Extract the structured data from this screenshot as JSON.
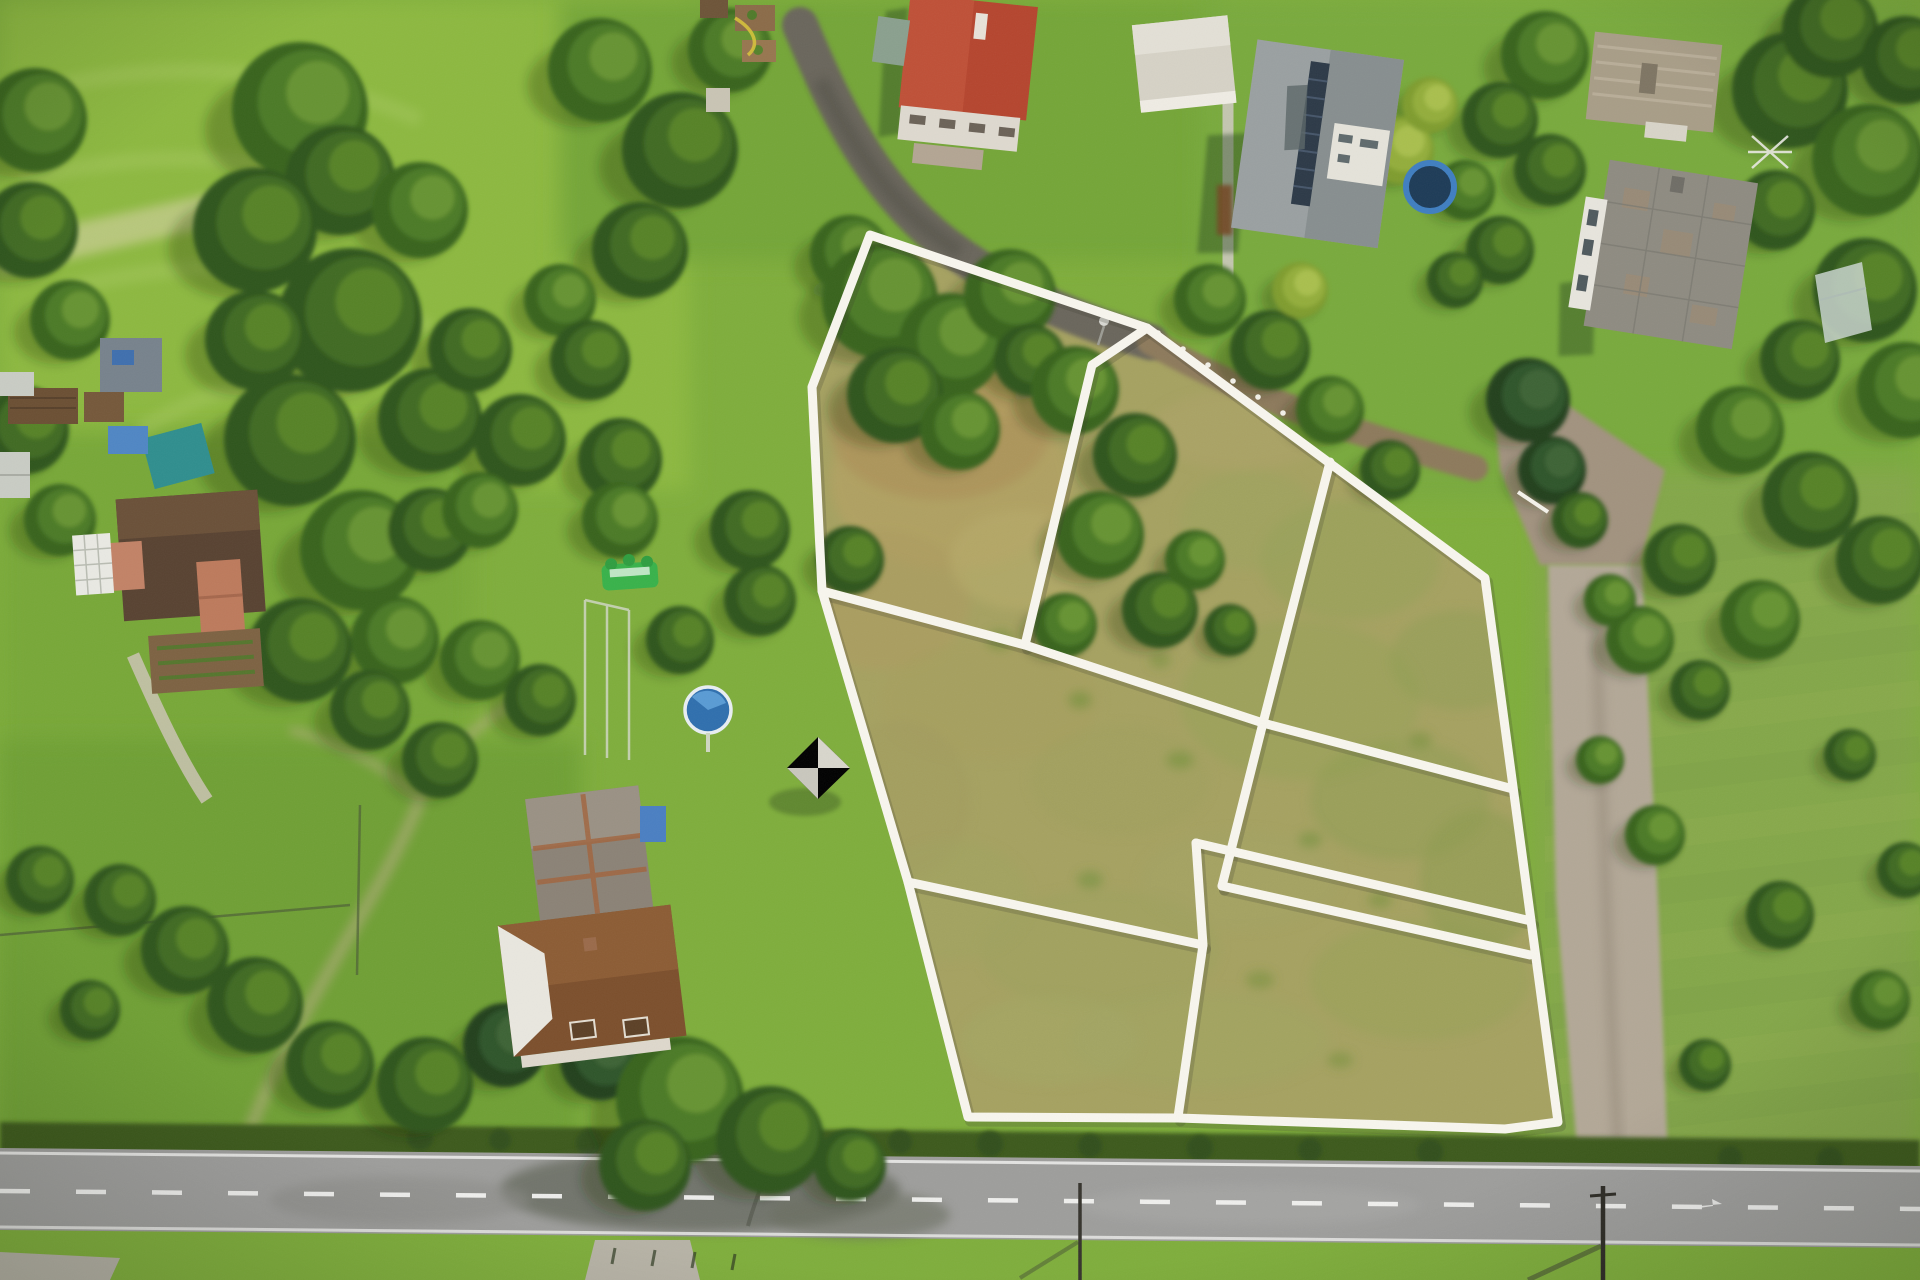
{
  "scene": {
    "type": "aerial-drone-photograph",
    "description": "Top-down aerial photo of a rural property: dry grass building parcels outlined with white boundary lines, surrounded by woodland, village houses with red, gray and brown roofs, a gravel driveway on the right and an asphalt road along the bottom. No text appears in the image.",
    "image_size": {
      "width": 1920,
      "height": 1280
    },
    "no_text_present": true,
    "approx_parcel_count": 7,
    "palette": {
      "white_line": "#f8f6ee",
      "line_shadow": "#3d3d2e",
      "lawn_green": "#7fae3c",
      "field_light": "#8db93f",
      "meadow_left": "#78a837",
      "meadow_right": "#84a748",
      "dry_parcel": "#a6a261",
      "tree_dark": "#2d541b",
      "hedge_dark": "#3c5a1e",
      "road_asphalt": "#9e9e9c",
      "gravel_drive": "#b3a897",
      "dirt_path": "#8d7a5b",
      "red_roof": "#b5452e",
      "gray_roof": "#9aa0a1",
      "slate_roof": "#8e8b81",
      "tan_roof": "#a89d87",
      "brown_roof": "#7c4f2c",
      "barn_roof": "#8b8276",
      "farmhouse_roof": "#584231",
      "pool_blue": "#3b82c4",
      "trampoline_blue": "#3f7ec0",
      "bouncy_castle_green": "#38b24a",
      "solar_panel": "#2c3947"
    },
    "parcel_overlay": {
      "line_color": "#f8f6ee",
      "line_width": 9,
      "outer_boundary": [
        [
          870,
          235
        ],
        [
          1147,
          328
        ],
        [
          1485,
          578
        ],
        [
          1558,
          1122
        ],
        [
          1505,
          1129
        ],
        [
          1360,
          1124
        ],
        [
          1178,
          1118
        ],
        [
          968,
          1117
        ],
        [
          908,
          882
        ],
        [
          822,
          591
        ],
        [
          812,
          387
        ]
      ],
      "inner_lines": [
        [
          [
            1147,
            328
          ],
          [
            1092,
            365
          ],
          [
            1025,
            645
          ]
        ],
        [
          [
            822,
            591
          ],
          [
            1025,
            645
          ],
          [
            1263,
            723
          ],
          [
            1513,
            789
          ]
        ],
        [
          [
            1330,
            462
          ],
          [
            1263,
            723
          ],
          [
            1222,
            886
          ]
        ],
        [
          [
            1196,
            843
          ],
          [
            1531,
            921
          ]
        ],
        [
          [
            1196,
            843
          ],
          [
            1203,
            945
          ],
          [
            1178,
            1117
          ]
        ],
        [
          [
            908,
            882
          ],
          [
            1203,
            945
          ]
        ],
        [
          [
            1222,
            886
          ],
          [
            1530,
            955
          ]
        ]
      ]
    },
    "vegetation_clusters": [
      [
        35,
        120,
        52,
        1
      ],
      [
        30,
        230,
        48,
        0
      ],
      [
        70,
        320,
        40,
        1
      ],
      [
        25,
        430,
        44,
        0
      ],
      [
        60,
        520,
        36,
        1
      ],
      [
        300,
        110,
        68,
        1
      ],
      [
        340,
        180,
        55,
        0
      ],
      [
        255,
        230,
        62,
        0
      ],
      [
        420,
        210,
        48,
        1
      ],
      [
        350,
        320,
        72,
        0
      ],
      [
        255,
        340,
        50,
        0
      ],
      [
        290,
        440,
        66,
        0
      ],
      [
        430,
        420,
        52,
        0
      ],
      [
        360,
        550,
        60,
        1
      ],
      [
        430,
        530,
        42,
        0
      ],
      [
        300,
        650,
        52,
        0
      ],
      [
        395,
        640,
        44,
        1
      ],
      [
        370,
        710,
        40,
        0
      ],
      [
        600,
        70,
        52,
        1
      ],
      [
        680,
        150,
        58,
        0
      ],
      [
        730,
        50,
        42,
        1
      ],
      [
        640,
        250,
        48,
        0
      ],
      [
        560,
        300,
        36,
        1
      ],
      [
        470,
        350,
        42,
        0
      ],
      [
        520,
        440,
        46,
        0
      ],
      [
        480,
        510,
        38,
        1
      ],
      [
        590,
        360,
        40,
        0
      ],
      [
        620,
        460,
        42,
        0
      ],
      [
        620,
        520,
        38,
        1
      ],
      [
        750,
        530,
        40,
        0
      ],
      [
        680,
        640,
        34,
        0
      ],
      [
        480,
        660,
        40,
        1
      ],
      [
        540,
        700,
        36,
        0
      ],
      [
        440,
        760,
        38,
        0
      ],
      [
        760,
        600,
        36,
        0
      ],
      [
        850,
        560,
        34,
        0
      ],
      [
        850,
        255,
        40,
        1
      ],
      [
        880,
        300,
        58,
        1
      ],
      [
        950,
        345,
        52,
        1
      ],
      [
        1010,
        295,
        46,
        1
      ],
      [
        895,
        395,
        48,
        0
      ],
      [
        960,
        430,
        40,
        1
      ],
      [
        1030,
        360,
        36,
        0
      ],
      [
        1075,
        390,
        44,
        1
      ],
      [
        1135,
        455,
        42,
        0
      ],
      [
        1100,
        535,
        44,
        1
      ],
      [
        1160,
        610,
        38,
        0
      ],
      [
        1065,
        625,
        32,
        1
      ],
      [
        1195,
        560,
        30,
        1
      ],
      [
        1230,
        630,
        26,
        0
      ],
      [
        1210,
        300,
        36,
        1
      ],
      [
        1270,
        350,
        40,
        0
      ],
      [
        1330,
        410,
        34,
        1
      ],
      [
        1390,
        470,
        30,
        0
      ],
      [
        1300,
        290,
        28,
        3
      ],
      [
        1545,
        55,
        44,
        1
      ],
      [
        1500,
        120,
        38,
        0
      ],
      [
        1550,
        170,
        36,
        0
      ],
      [
        1790,
        90,
        58,
        0
      ],
      [
        1868,
        160,
        56,
        1
      ],
      [
        1830,
        30,
        48,
        0
      ],
      [
        1905,
        60,
        44,
        0
      ],
      [
        1775,
        210,
        40,
        0
      ],
      [
        1865,
        290,
        52,
        0
      ],
      [
        1905,
        390,
        48,
        1
      ],
      [
        1800,
        360,
        40,
        0
      ],
      [
        1740,
        430,
        44,
        1
      ],
      [
        1810,
        500,
        48,
        0
      ],
      [
        1880,
        560,
        44,
        0
      ],
      [
        1760,
        620,
        40,
        1
      ],
      [
        1680,
        560,
        36,
        0
      ],
      [
        1640,
        640,
        34,
        1
      ],
      [
        1700,
        690,
        30,
        0
      ],
      [
        1528,
        400,
        42,
        2
      ],
      [
        1552,
        470,
        34,
        2
      ],
      [
        1400,
        150,
        34,
        3
      ],
      [
        1430,
        105,
        28,
        3
      ],
      [
        1465,
        190,
        30,
        1
      ],
      [
        1500,
        250,
        34,
        0
      ],
      [
        1455,
        280,
        28,
        0
      ],
      [
        40,
        880,
        34,
        0
      ],
      [
        90,
        1010,
        30,
        0
      ],
      [
        120,
        900,
        36,
        0
      ],
      [
        185,
        950,
        44,
        0
      ],
      [
        255,
        1005,
        48,
        0
      ],
      [
        330,
        1065,
        44,
        0
      ],
      [
        425,
        1085,
        48,
        0
      ],
      [
        505,
        1045,
        42,
        2
      ],
      [
        560,
        1000,
        36,
        2
      ],
      [
        600,
        1060,
        40,
        2
      ],
      [
        680,
        1100,
        64,
        1
      ],
      [
        770,
        1140,
        54,
        0
      ],
      [
        645,
        1165,
        46,
        0
      ],
      [
        850,
        1165,
        36,
        0
      ],
      [
        1655,
        835,
        30,
        1
      ],
      [
        1780,
        915,
        34,
        0
      ],
      [
        1880,
        1000,
        30,
        1
      ],
      [
        1705,
        1065,
        26,
        0
      ],
      [
        1850,
        755,
        26,
        0
      ],
      [
        1905,
        870,
        28,
        0
      ],
      [
        1600,
        760,
        24,
        1
      ],
      [
        1580,
        520,
        28,
        0
      ],
      [
        1610,
        600,
        26,
        1
      ]
    ],
    "grass_patches": [
      [
        950,
        480,
        120,
        90,
        "#b3a163",
        0.8
      ],
      [
        940,
        430,
        110,
        70,
        "#ab9258",
        0.7
      ],
      [
        1000,
        380,
        60,
        40,
        "#b29b5e",
        0.6
      ],
      [
        880,
        600,
        90,
        70,
        "#ac9c60",
        0.7
      ],
      [
        1020,
        560,
        70,
        50,
        "#b8ab6a",
        0.6
      ],
      [
        990,
        700,
        110,
        60,
        "#a79f5e",
        0.6
      ],
      [
        1120,
        780,
        90,
        55,
        "#9fa05c",
        0.5
      ],
      [
        1240,
        880,
        100,
        50,
        "#a3a462",
        0.5
      ],
      [
        1100,
        950,
        120,
        60,
        "#9da25e",
        0.5
      ],
      [
        1300,
        700,
        120,
        80,
        "#96a156",
        0.5
      ],
      [
        1400,
        800,
        90,
        60,
        "#8f9e52",
        0.5
      ],
      [
        1350,
        560,
        90,
        60,
        "#93a258",
        0.5
      ],
      [
        1250,
        520,
        70,
        50,
        "#9aa65c",
        0.4
      ],
      [
        1240,
        430,
        90,
        40,
        "#adа468",
        0.5
      ],
      [
        1420,
        980,
        110,
        60,
        "#97a258",
        0.5
      ],
      [
        1200,
        1040,
        130,
        50,
        "#a0a560",
        0.5
      ],
      [
        1050,
        1040,
        90,
        45,
        "#a4a763",
        0.5
      ],
      [
        900,
        800,
        70,
        80,
        "#a29c5e",
        0.5
      ],
      [
        950,
        900,
        80,
        60,
        "#9fa35f",
        0.45
      ],
      [
        1480,
        880,
        60,
        70,
        "#8c9b50",
        0.5
      ],
      [
        1460,
        660,
        70,
        50,
        "#8e9e53",
        0.45
      ],
      [
        1000,
        640,
        14,
        10,
        "#6f8f3a",
        0.6
      ],
      [
        1080,
        700,
        12,
        9,
        "#6f8f3a",
        0.6
      ],
      [
        1180,
        760,
        14,
        9,
        "#70903a",
        0.55
      ],
      [
        1310,
        840,
        12,
        8,
        "#70903a",
        0.55
      ],
      [
        1090,
        880,
        13,
        9,
        "#6f8f3a",
        0.55
      ],
      [
        1260,
        980,
        14,
        9,
        "#6f8f3a",
        0.5
      ],
      [
        1380,
        900,
        12,
        8,
        "#70903a",
        0.5
      ],
      [
        1160,
        660,
        11,
        8,
        "#6f8f3a",
        0.5
      ],
      [
        1420,
        740,
        12,
        8,
        "#70903a",
        0.5
      ],
      [
        1340,
        1060,
        13,
        8,
        "#6f8f3a",
        0.5
      ]
    ],
    "landmarks": [
      {
        "id": "red-roof-house",
        "label": "House with red tiled roof"
      },
      {
        "id": "white-garage",
        "label": "Light flat-roof outbuilding"
      },
      {
        "id": "solar-panel-house",
        "label": "Gray-roof house with solar panels"
      },
      {
        "id": "trampoline",
        "label": "Blue garden trampoline"
      },
      {
        "id": "tan-roof-house",
        "label": "Cottage with tan corrugated roof"
      },
      {
        "id": "slate-roof-house",
        "label": "Large house with weathered slate roof"
      },
      {
        "id": "greenhouse",
        "label": "Small greenhouse"
      },
      {
        "id": "left-farmhouse",
        "label": "Farmhouse with dark brown roof"
      },
      {
        "id": "pergola",
        "label": "White pergola lattice"
      },
      {
        "id": "vegetable-garden",
        "label": "Vegetable garden beds"
      },
      {
        "id": "teal-vehicle",
        "label": "Teal vehicle and trailer"
      },
      {
        "id": "barn",
        "label": "Weathered barn roof"
      },
      {
        "id": "brown-roof-house",
        "label": "House with brown hipped roof and dormers"
      },
      {
        "id": "garden-gazebo",
        "label": "White pyramid garden gazebo"
      },
      {
        "id": "round-pool",
        "label": "Round above-ground pool"
      },
      {
        "id": "bouncy-castle",
        "label": "Green inflatable bouncy castle"
      },
      {
        "id": "access-path",
        "label": "Asphalt access lane"
      },
      {
        "id": "gravel-driveway",
        "label": "Gravel driveway"
      },
      {
        "id": "asphalt-road",
        "label": "Asphalt road with dashed center line"
      },
      {
        "id": "utility-pole",
        "label": "Utility pole"
      },
      {
        "id": "parcel-boundary-overlay",
        "label": "White parcel boundary overlay"
      },
      {
        "id": "hedgerow",
        "label": "Hedgerow along road"
      },
      {
        "id": "meadow",
        "label": "Green meadows"
      },
      {
        "id": "woodland",
        "label": "Tree clusters"
      }
    ],
    "road": {
      "lane_marking": "dashed-white-center",
      "edge_lines": "solid-white",
      "direction": "horizontal"
    }
  }
}
